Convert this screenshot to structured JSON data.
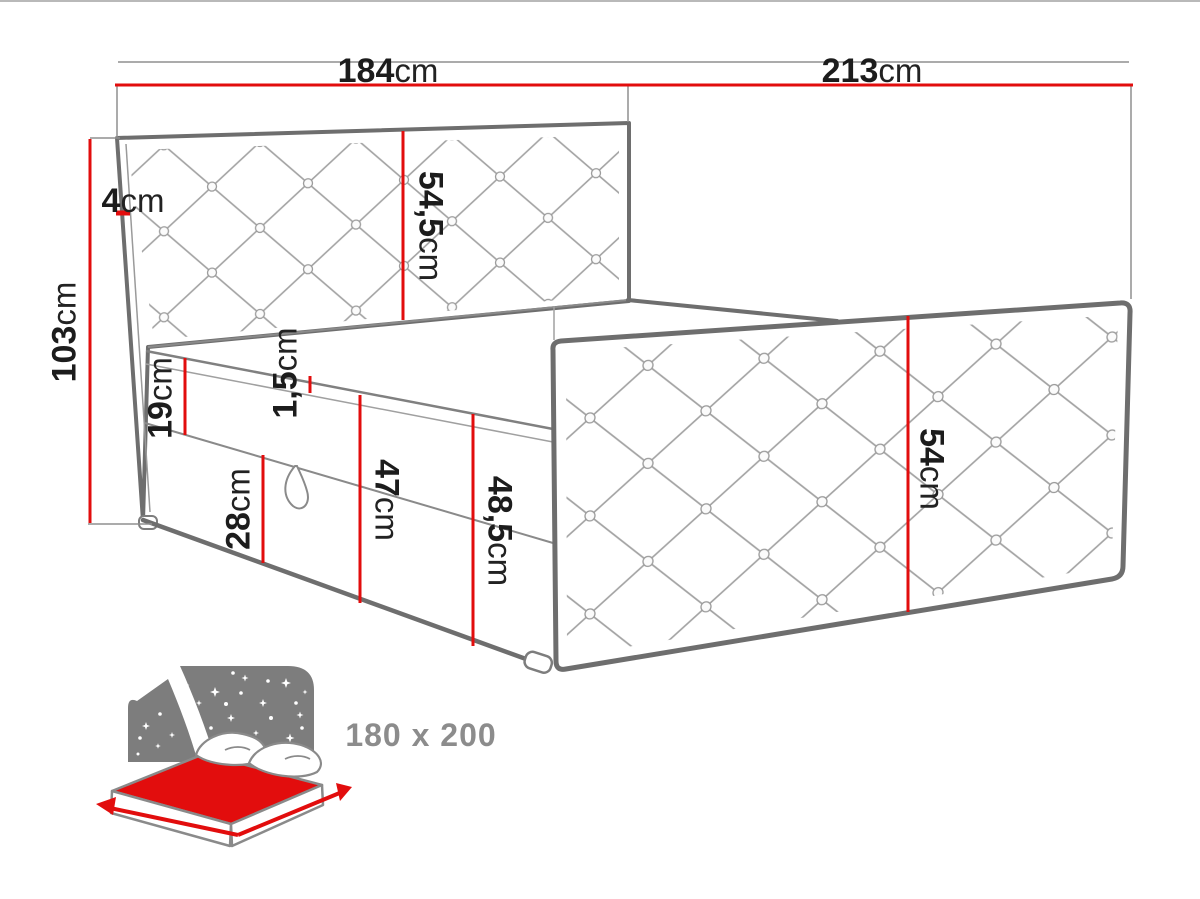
{
  "title": "Bed dimensions diagram",
  "colors": {
    "dimension_red": "#e20d0d",
    "outline_gray": "#6e6e6e",
    "quilt_gray": "#a3a3a3",
    "icon_gray": "#7d7d7d",
    "label_dark": "#1c1c1c",
    "size_text_gray": "#8c8c8c"
  },
  "dimensions": {
    "headboard_width": {
      "value": "184",
      "unit": "cm"
    },
    "total_length": {
      "value": "213",
      "unit": "cm"
    },
    "top_edge": {
      "value": "4",
      "unit": "cm"
    },
    "headboard_height": {
      "value": "103",
      "unit": "cm"
    },
    "headboard_panel": {
      "value": "54,5",
      "unit": "cm"
    },
    "mattress_height": {
      "value": "19",
      "unit": "cm"
    },
    "seam_gap": {
      "value": "1,5",
      "unit": "cm"
    },
    "box_height": {
      "value": "28",
      "unit": "cm"
    },
    "side_total": {
      "value": "47",
      "unit": "cm"
    },
    "front_total": {
      "value": "48,5",
      "unit": "cm"
    },
    "footboard_height": {
      "value": "54",
      "unit": "cm"
    }
  },
  "badge": {
    "size": "180 x 200"
  }
}
